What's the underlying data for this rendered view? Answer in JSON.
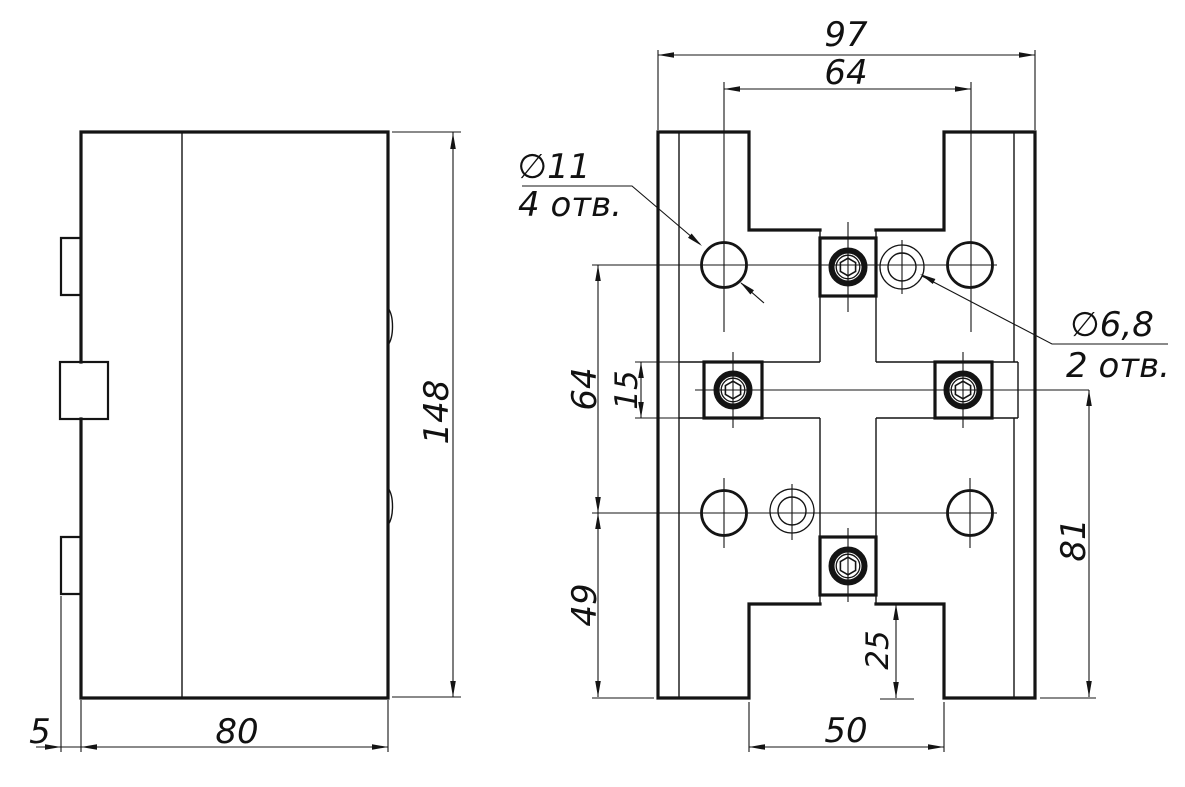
{
  "drawing": {
    "side_view": {
      "dims": {
        "body_width": "80",
        "flange_offset": "5",
        "height": "148"
      }
    },
    "front_view": {
      "dims": {
        "overall_width": "97",
        "hole_spacing_top": "64",
        "hole_spacing_left": "64",
        "slot_width": "15",
        "bottom_row_offset": "49",
        "right_height": "81",
        "notch_depth": "25",
        "notch_width": "50"
      },
      "hole_labels": {
        "large_dia": "∅11",
        "large_qty": "4 отв.",
        "small_dia": "∅6,8",
        "small_qty": "2 отв."
      }
    }
  }
}
